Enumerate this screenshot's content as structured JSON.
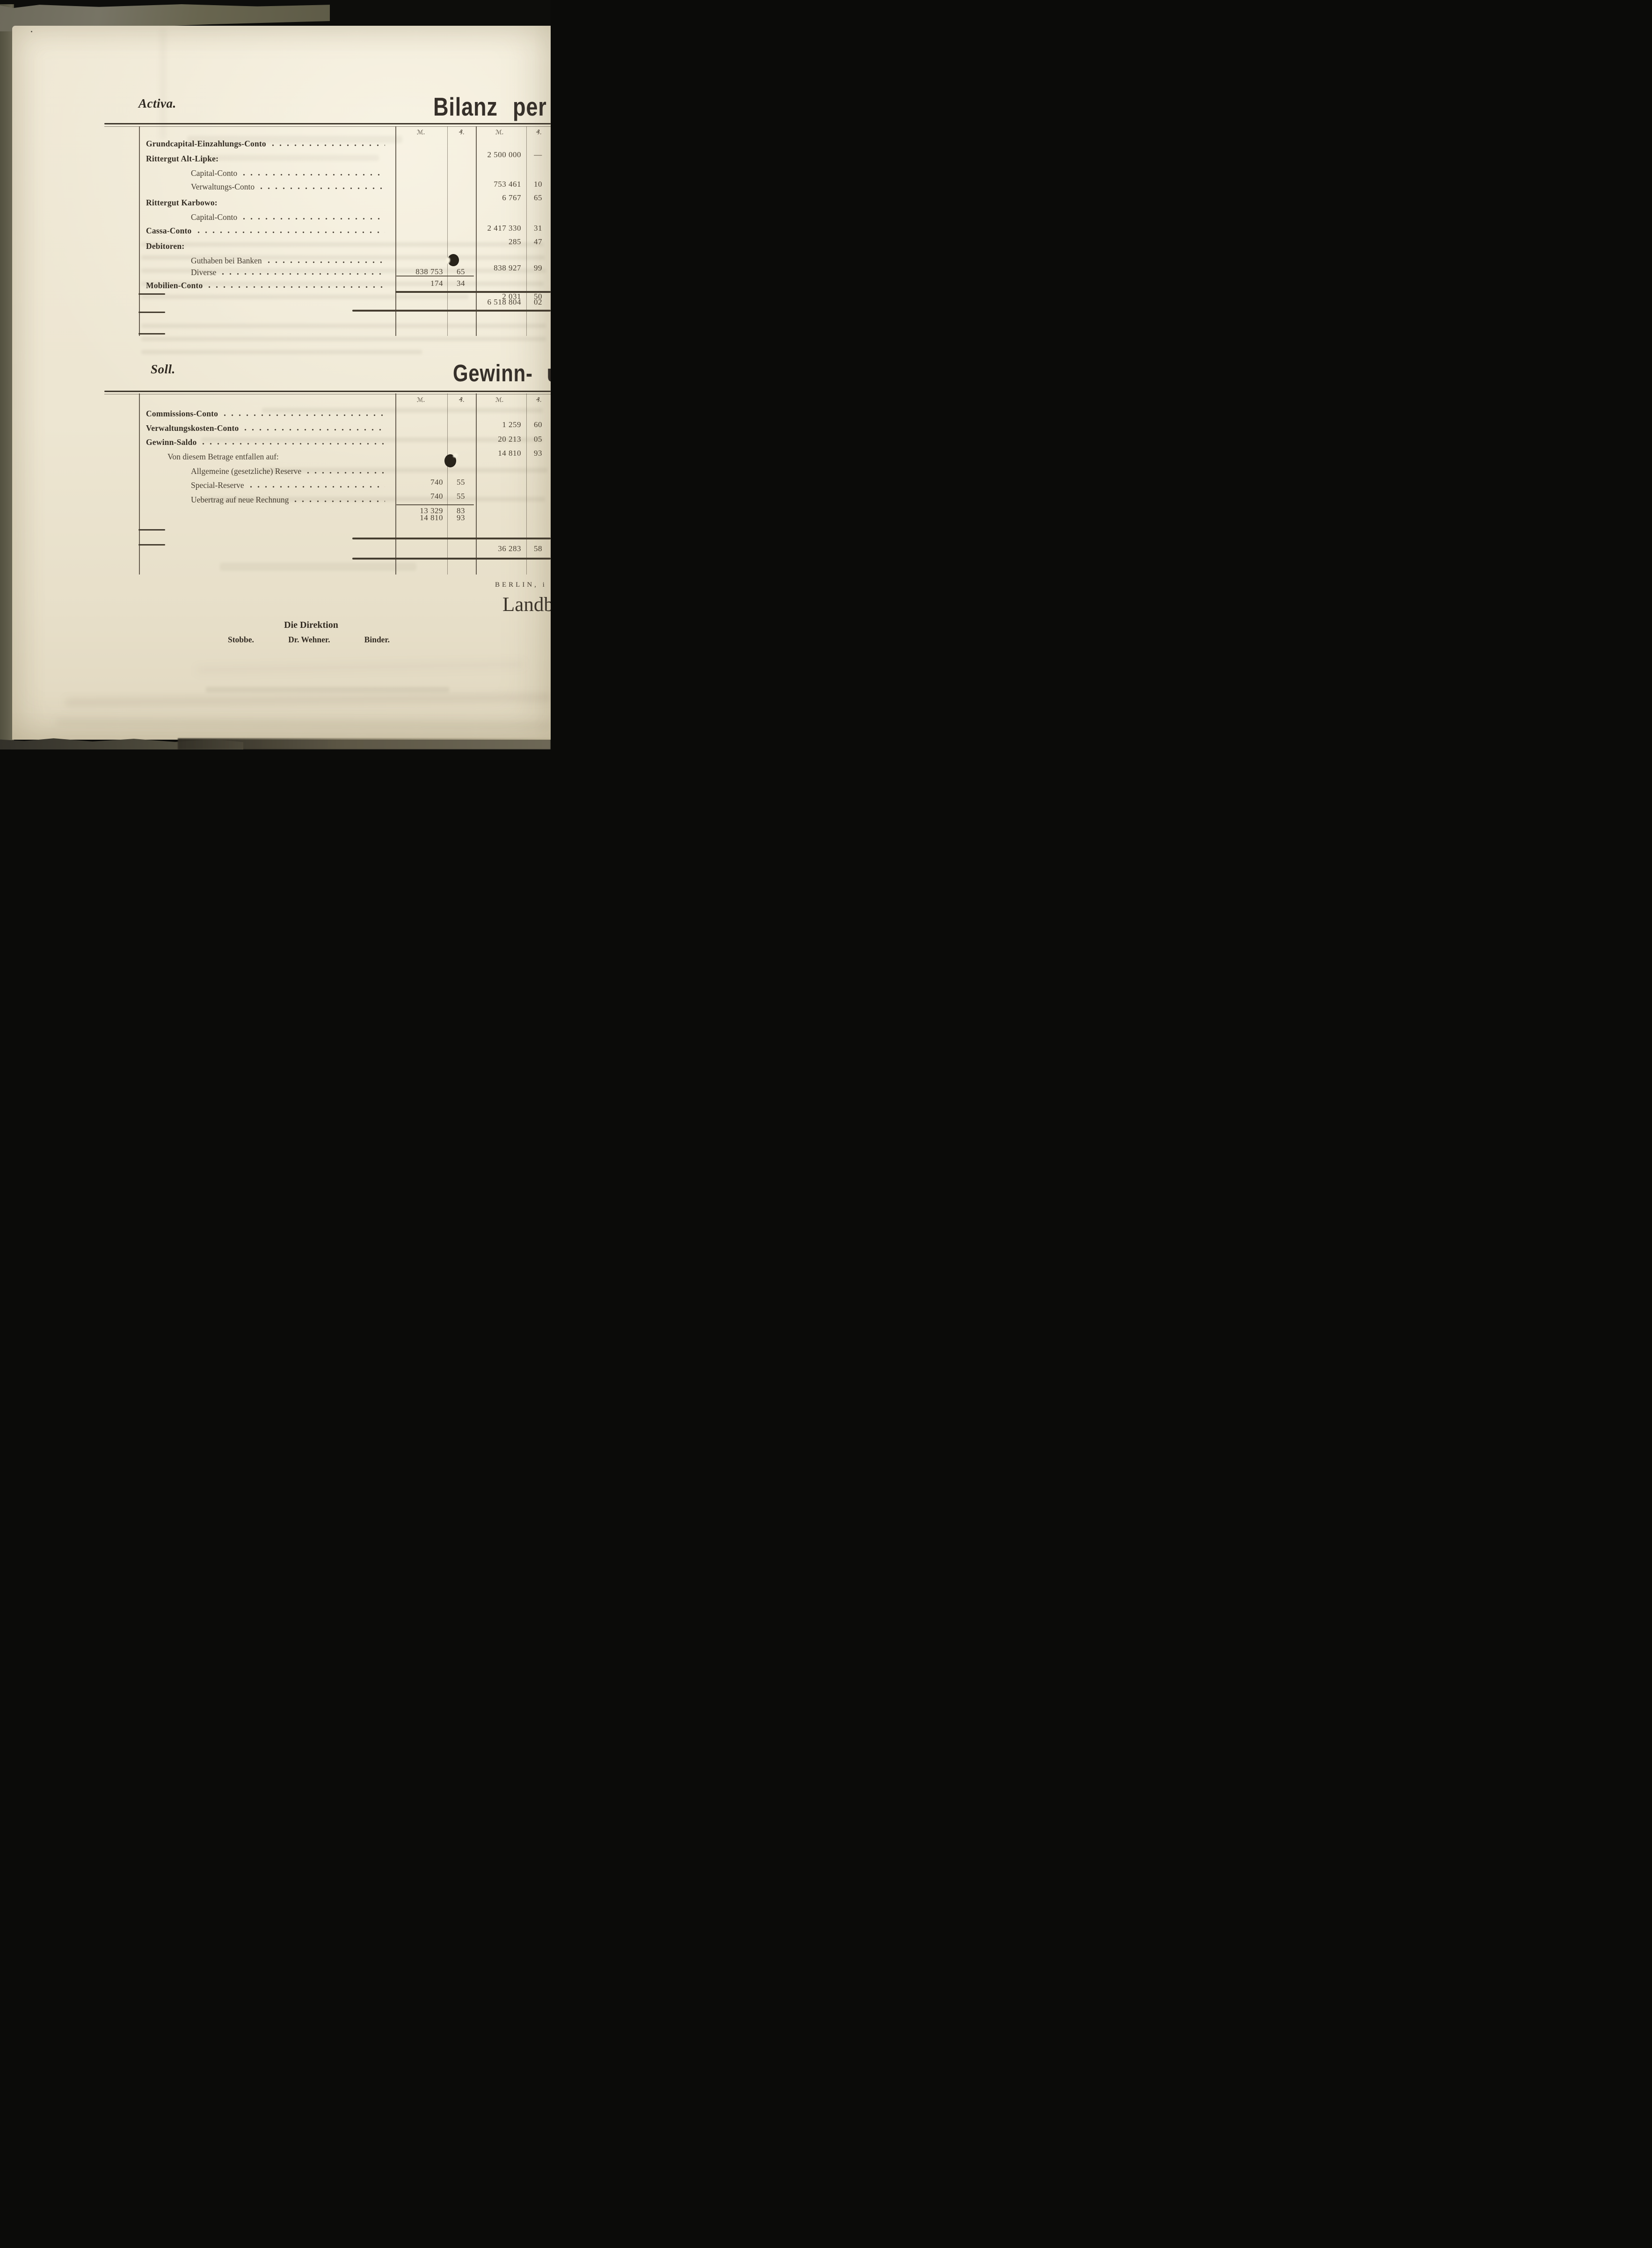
{
  "page": {
    "activa_heading": "Activa.",
    "bilanz_heading": "Bilanz per 31.",
    "soll_heading": "Soll.",
    "gewinn_heading": "Gewinn- und",
    "berlin_line": "BERLIN, i",
    "landbank_partial": "Landb",
    "direktion_heading": "Die Direktion",
    "signatures": [
      "Stobbe.",
      "Dr. Wehner.",
      "Binder."
    ]
  },
  "activa_table": {
    "column_headers": [
      "ℳ.",
      "₰.",
      "ℳ.",
      "₰."
    ],
    "rows": [
      {
        "label": "Grundcapital-Einzahlungs-Conto",
        "bold": true,
        "indent": 0,
        "dots": true,
        "m2": "2 500 000",
        "p2": "—"
      },
      {
        "label": "Rittergut Alt-Lipke:",
        "bold": true,
        "indent": 0
      },
      {
        "label": "Capital-Conto",
        "indent": 1,
        "dots": true,
        "m2": "753 461",
        "p2": "10"
      },
      {
        "label": "Verwaltungs-Conto",
        "indent": 1,
        "dots": true,
        "m2": "6 767",
        "p2": "65"
      },
      {
        "label": "Rittergut Karbowo:",
        "bold": true,
        "indent": 0
      },
      {
        "label": "Capital-Conto",
        "indent": 1,
        "dots": true,
        "m2": "2 417 330",
        "p2": "31"
      },
      {
        "label": "Cassa-Conto",
        "bold": true,
        "indent": 0,
        "dots": true,
        "m2": "285",
        "p2": "47"
      },
      {
        "label": "Debitoren:",
        "bold": true,
        "indent": 0
      },
      {
        "label": "Guthaben bei Banken",
        "indent": 1,
        "dots": true,
        "m1": "838 753",
        "p1": "65"
      },
      {
        "label": "Diverse",
        "indent": 1,
        "dots": true,
        "m1": "174",
        "p1": "34",
        "m2": "838 927",
        "p2": "99"
      },
      {
        "label": "Mobilien-Conto",
        "bold": true,
        "indent": 0,
        "dots": true,
        "m2": "2 031",
        "p2": "50"
      },
      {
        "total": true,
        "m2": "6 518 804",
        "p2": "02"
      }
    ]
  },
  "soll_table": {
    "column_headers": [
      "ℳ.",
      "₰.",
      "ℳ.",
      "₰."
    ],
    "rows": [
      {
        "label": "Commissions-Conto",
        "bold": true,
        "indent": 0,
        "dots": true,
        "m2": "1 259",
        "p2": "60"
      },
      {
        "label": "Verwaltungskosten-Conto",
        "bold": true,
        "indent": 0,
        "dots": true,
        "m2": "20 213",
        "p2": "05"
      },
      {
        "label": "Gewinn-Saldo",
        "bold": true,
        "indent": 0,
        "dots": true,
        "m2": "14 810",
        "p2": "93"
      },
      {
        "label": "Von diesem Betrage entfallen auf:",
        "indent": 2
      },
      {
        "label": "Allgemeine (gesetzliche) Reserve",
        "indent": 1,
        "dots": true,
        "m1": "740",
        "p1": "55"
      },
      {
        "label": "Special-Reserve",
        "indent": 1,
        "dots": true,
        "m1": "740",
        "p1": "55"
      },
      {
        "label": "Uebertrag auf neue Rechnung",
        "indent": 1,
        "dots": true,
        "m1": "13 329",
        "p1": "83"
      },
      {
        "label": "",
        "indent": 1,
        "m1": "14 810",
        "p1": "93"
      },
      {
        "total": true,
        "m2": "36 283",
        "p2": "58"
      }
    ]
  }
}
